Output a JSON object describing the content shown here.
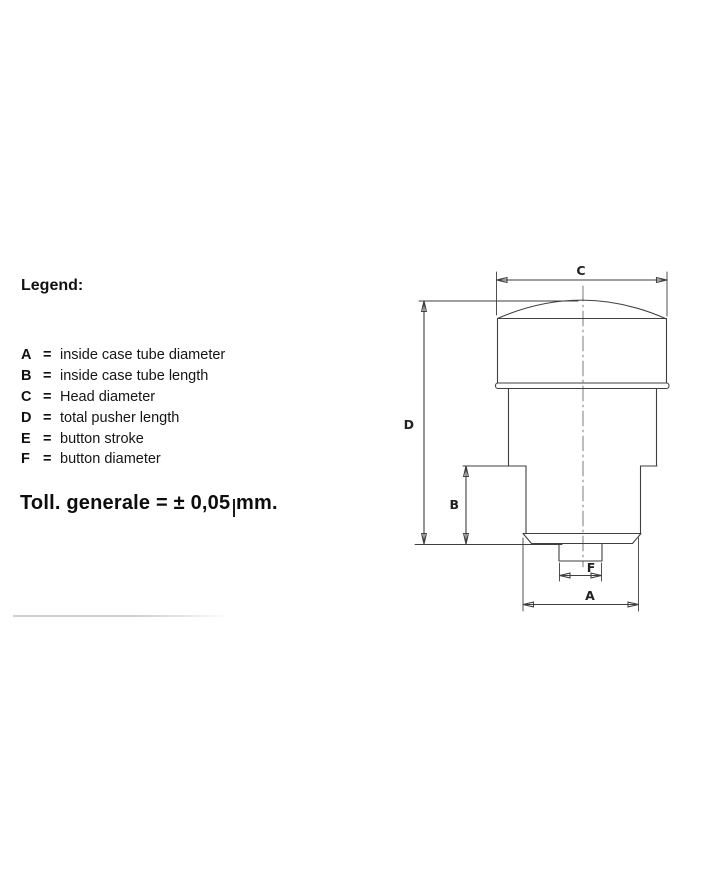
{
  "colors": {
    "background": "#ffffff",
    "drawing_line": "#3f3f3f",
    "text": "#111111",
    "divider": "#cfcfcf"
  },
  "legend": {
    "heading": "Legend:",
    "items": [
      {
        "key": "A",
        "separator": "=",
        "description": "inside case tube diameter"
      },
      {
        "key": "B",
        "separator": "=",
        "description": "inside case tube length"
      },
      {
        "key": "C",
        "separator": "=",
        "description": "Head diameter"
      },
      {
        "key": "D",
        "separator": "=",
        "description": "total pusher length"
      },
      {
        "key": "E",
        "separator": "=",
        "description": "button stroke"
      },
      {
        "key": "F",
        "separator": "=",
        "description": "button diameter"
      }
    ],
    "tolerance_note": "Toll. generale = ± 0,05 mm."
  },
  "diagram": {
    "type": "technical-drawing",
    "subject": "pusher side view with dimension lines",
    "dim_labels": {
      "head_diameter": "C",
      "total_pusher_length": "D",
      "inside_case_tube_length": "B",
      "button_diameter": "F",
      "inside_case_tube_diameter": "A"
    }
  }
}
